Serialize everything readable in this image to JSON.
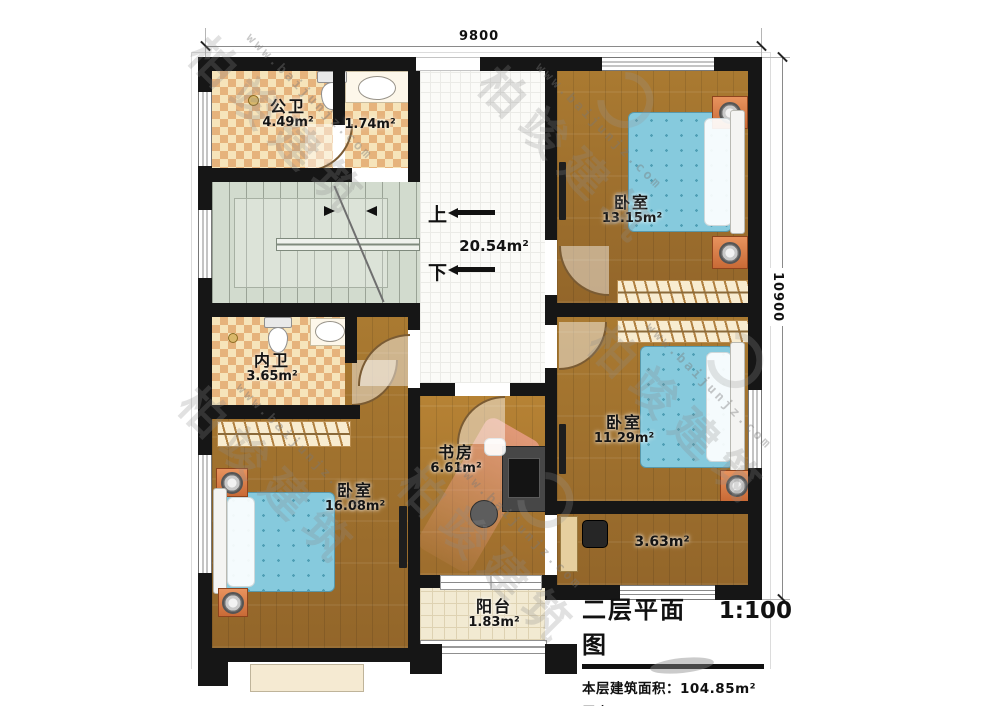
{
  "dimensions": {
    "top": "9800",
    "right": "10900"
  },
  "stairs": {
    "up": "上",
    "down": "下"
  },
  "rooms": {
    "public_bath": {
      "name": "公卫",
      "area": "4.49m²"
    },
    "small_bath": {
      "area": "1.74m²"
    },
    "hall": {
      "area": "20.54m²"
    },
    "ensuite_bath": {
      "name": "内卫",
      "area": "3.65m²"
    },
    "study": {
      "name": "书房",
      "area": "6.61m²"
    },
    "bedroom_top": {
      "name": "卧室",
      "area": "13.15m²"
    },
    "bedroom_right": {
      "name": "卧室",
      "area": "11.29m²"
    },
    "bedroom_left": {
      "name": "卧室",
      "area": "16.08m²"
    },
    "corridor": {
      "area": "3.63m²"
    },
    "balcony": {
      "name": "阳台",
      "area": "1.83m²"
    }
  },
  "title_block": {
    "title": "二层平面图",
    "scale": "1:100",
    "area_label": "本层建筑面积：",
    "area_value": "104.85m²",
    "height_label": "层高：",
    "height_value": "3.3m"
  },
  "watermark": {
    "brand": "柏竣建筑",
    "url": "www.baijunjz.com"
  },
  "colors": {
    "wall": "#161616",
    "wood": "#a1702b",
    "checker": "#e6b37c",
    "mattress": "#86cadd",
    "nightstand": "#d9854f",
    "stairs": "#d2dbce"
  }
}
